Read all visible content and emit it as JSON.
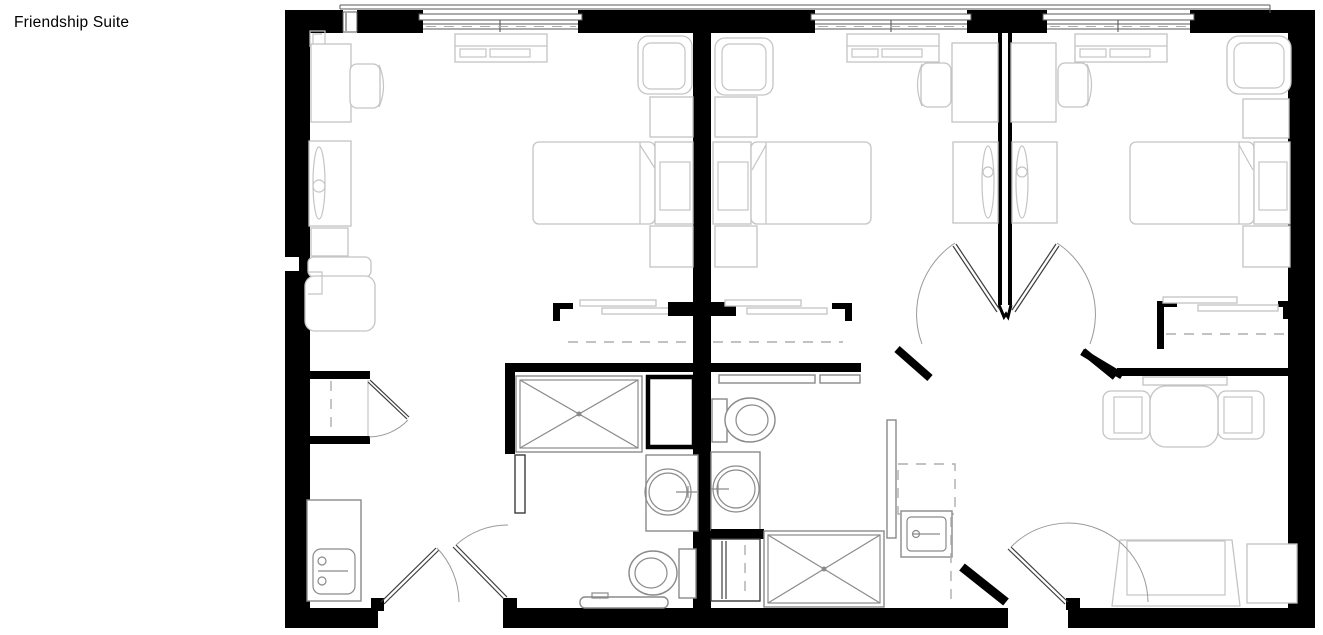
{
  "title": "Friendship Suite",
  "colors": {
    "wall": "#000000",
    "furniture": "#c4c4c4",
    "fixture": "#8a8a8a",
    "door": "#3c3c3c",
    "background": "#ffffff"
  },
  "plan": {
    "type": "architectural-floor-plan",
    "suites": [
      {
        "name": "suite-left",
        "rooms": [
          "bedroom",
          "bathroom",
          "entry"
        ],
        "fixtures": [
          "desk",
          "desk-chair",
          "tv-cabinet",
          "side-table",
          "armchair",
          "window-console",
          "bed",
          "nightstand",
          "nightstand",
          "lounge-chair",
          "wardrobe-closet",
          "coat-closet",
          "in-room-sink-cabinet",
          "shower",
          "vanity-sink",
          "toilet",
          "linen-shaft",
          "entry-door",
          "bathroom-door",
          "closet-door"
        ]
      },
      {
        "name": "suite-right",
        "rooms": [
          "bedroom-1",
          "bedroom-2",
          "shared-bathroom",
          "entry-hall"
        ],
        "fixtures": [
          "armchair",
          "bed",
          "nightstand",
          "nightstand",
          "window-console",
          "desk",
          "desk-chair",
          "tv-cabinet",
          "tv-cabinet",
          "desk",
          "desk-chair",
          "wardrobe-closet",
          "wardrobe-closet",
          "toilet",
          "vanity-sink",
          "shower",
          "utility-sink",
          "storage-closet",
          "bed",
          "nightstand",
          "nightstand",
          "table-with-two-chairs",
          "loveseat",
          "side-table",
          "double-swing-doors",
          "entry-door",
          "window-console",
          "corner-armchair"
        ]
      }
    ],
    "windows": 4,
    "wall_color": "#000000"
  }
}
